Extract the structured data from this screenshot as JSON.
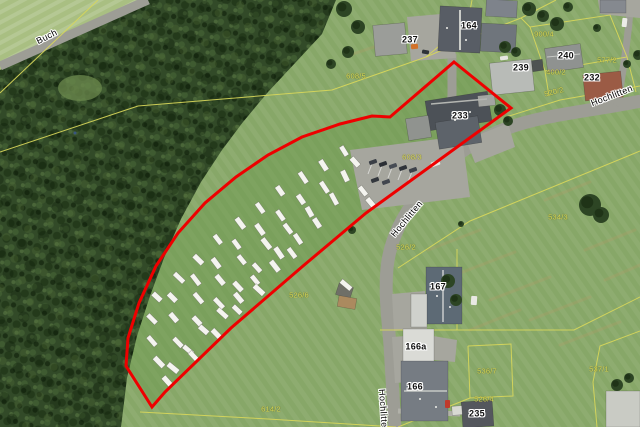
{
  "map": {
    "kind": "aerial-orthophoto-with-cadastre",
    "width": 640,
    "height": 427
  },
  "colors": {
    "meadow": "#87a768",
    "meadow_light": "#a9bf82",
    "field_tint": "#6e9950",
    "clearing": "#6c8a4e",
    "tree": "#2d4524",
    "tree_dark": "#1f3317",
    "road": "#9d9d95",
    "asphalt": "#a6a69e",
    "path": "#b1b1a9",
    "cadastral_yellow": "#d8d75a",
    "boundary_red": "#ee0000",
    "dry_grass": "#b59c66",
    "caravan_white": "#f4f4ef",
    "house_label": "#101010",
    "parcel_label": "#dedd55",
    "marker_blue": "#39567f"
  },
  "labels": {
    "streets": [
      {
        "text": "Buch",
        "x": 47,
        "y": 37,
        "rot": -27
      },
      {
        "text": "Hochlitten",
        "x": 612,
        "y": 96,
        "rot": -21
      },
      {
        "text": "Hochlitten",
        "x": 407,
        "y": 219,
        "rot": -50
      },
      {
        "text": "Hochlitten",
        "x": 383,
        "y": 411,
        "rot": 86
      }
    ],
    "house_numbers": [
      {
        "text": "164",
        "x": 469,
        "y": 26,
        "rot": 0
      },
      {
        "text": "237",
        "x": 410,
        "y": 40,
        "rot": 0
      },
      {
        "text": "240",
        "x": 566,
        "y": 56,
        "rot": 0
      },
      {
        "text": "239",
        "x": 521,
        "y": 68,
        "rot": 0
      },
      {
        "text": "232",
        "x": 592,
        "y": 78,
        "rot": 0
      },
      {
        "text": "233",
        "x": 460,
        "y": 116,
        "rot": 0
      },
      {
        "text": "167",
        "x": 438,
        "y": 287,
        "rot": 0
      },
      {
        "text": "166a",
        "x": 416,
        "y": 347,
        "rot": 0
      },
      {
        "text": "166",
        "x": 415,
        "y": 387,
        "rot": 0
      },
      {
        "text": "235",
        "x": 477,
        "y": 414,
        "rot": 0
      }
    ],
    "parcels": [
      {
        "text": "900/4",
        "x": 544,
        "y": 34,
        "rot": 0
      },
      {
        "text": "400/2",
        "x": 556,
        "y": 72,
        "rot": 0
      },
      {
        "text": "577/2",
        "x": 607,
        "y": 60,
        "rot": 0
      },
      {
        "text": "520/2",
        "x": 554,
        "y": 92,
        "rot": -14
      },
      {
        "text": "608/5",
        "x": 356,
        "y": 76,
        "rot": 0
      },
      {
        "text": "608/3",
        "x": 412,
        "y": 157,
        "rot": 0
      },
      {
        "text": "534/3",
        "x": 558,
        "y": 217,
        "rot": 0
      },
      {
        "text": "526/2",
        "x": 406,
        "y": 247,
        "rot": 0
      },
      {
        "text": "526/6",
        "x": 299,
        "y": 295,
        "rot": 0
      },
      {
        "text": "536/7",
        "x": 487,
        "y": 371,
        "rot": 0
      },
      {
        "text": "526/4",
        "x": 484,
        "y": 399,
        "rot": 0
      },
      {
        "text": "537/1",
        "x": 599,
        "y": 369,
        "rot": 0
      },
      {
        "text": "614/2",
        "x": 271,
        "y": 409,
        "rot": 0
      }
    ]
  },
  "red_boundary": {
    "color": "#ee0000",
    "width": 3,
    "points": [
      [
        454,
        62
      ],
      [
        511,
        108
      ],
      [
        366,
        213
      ],
      [
        303,
        266
      ],
      [
        231,
        328
      ],
      [
        165,
        392
      ],
      [
        152,
        407
      ],
      [
        126,
        366
      ],
      [
        128,
        338
      ],
      [
        139,
        303
      ],
      [
        156,
        266
      ],
      [
        178,
        233
      ],
      [
        205,
        203
      ],
      [
        236,
        177
      ],
      [
        268,
        155
      ],
      [
        302,
        137
      ],
      [
        340,
        124
      ],
      [
        372,
        116
      ],
      [
        390,
        117
      ]
    ]
  },
  "forest": {
    "polygon": [
      [
        148,
        0
      ],
      [
        336,
        0
      ],
      [
        322,
        34
      ],
      [
        296,
        62
      ],
      [
        268,
        92
      ],
      [
        243,
        122
      ],
      [
        222,
        150
      ],
      [
        201,
        182
      ],
      [
        181,
        219
      ],
      [
        164,
        258
      ],
      [
        150,
        296
      ],
      [
        137,
        336
      ],
      [
        127,
        378
      ],
      [
        121,
        427
      ],
      [
        0,
        427
      ],
      [
        0,
        70
      ]
    ],
    "clearing": {
      "cx": 80,
      "cy": 88,
      "rx": 22,
      "ry": 13
    }
  },
  "surfaces": {
    "topleft_meadow": [
      [
        0,
        0
      ],
      [
        150,
        0
      ],
      [
        0,
        70
      ]
    ],
    "asphalt": [
      [
        [
          350,
          150
        ],
        [
          462,
          136
        ],
        [
          470,
          197
        ],
        [
          362,
          210
        ]
      ],
      [
        [
          466,
          140
        ],
        [
          508,
          123
        ],
        [
          515,
          147
        ],
        [
          475,
          163
        ]
      ],
      [
        [
          407,
          17
        ],
        [
          452,
          13
        ],
        [
          456,
          58
        ],
        [
          411,
          61
        ]
      ],
      [
        [
          392,
          294
        ],
        [
          425,
          291
        ],
        [
          427,
          329
        ],
        [
          394,
          331
        ]
      ],
      [
        [
          392,
          337
        ],
        [
          420,
          335
        ],
        [
          423,
          381
        ],
        [
          395,
          383
        ]
      ],
      [
        [
          433,
          336
        ],
        [
          457,
          340
        ],
        [
          455,
          362
        ],
        [
          434,
          360
        ]
      ],
      [
        [
          598,
          0
        ],
        [
          640,
          0
        ],
        [
          640,
          18
        ],
        [
          600,
          14
        ]
      ]
    ]
  },
  "roads": [
    {
      "d": "M0,66 L148,0",
      "w": 9
    },
    {
      "d": "M641,101 C585,112 542,115 505,129 C468,143 444,163 424,188 C404,213 390,238 387,268 C384,300 390,332 391,362 L395,428",
      "w": 13
    },
    {
      "d": "M617,106 C623,72 628,40 631,0",
      "w": 7
    },
    {
      "d": "M452,54 L452,95 L448,138",
      "w": 9
    },
    {
      "d": "M398,411 L460,414",
      "w": 5,
      "c": "#b1b1a9"
    }
  ],
  "cadastral_lines": [
    [
      [
        0,
        93
      ],
      [
        98,
        0
      ]
    ],
    [
      [
        0,
        152
      ],
      [
        138,
        106
      ],
      [
        332,
        90
      ],
      [
        426,
        57
      ]
    ],
    [
      [
        426,
        57
      ],
      [
        470,
        38
      ],
      [
        521,
        18
      ],
      [
        556,
        0
      ]
    ],
    [
      [
        521,
        18
      ],
      [
        530,
        27
      ],
      [
        545,
        71
      ],
      [
        549,
        96
      ]
    ],
    [
      [
        530,
        27
      ],
      [
        610,
        15
      ],
      [
        627,
        57
      ],
      [
        545,
        71
      ]
    ],
    [
      [
        627,
        57
      ],
      [
        636,
        92
      ]
    ],
    [
      [
        640,
        86
      ],
      [
        560,
        100
      ],
      [
        506,
        117
      ]
    ],
    [
      [
        398,
        268
      ],
      [
        470,
        221
      ],
      [
        640,
        151
      ]
    ],
    [
      [
        380,
        330
      ],
      [
        574,
        330
      ],
      [
        640,
        297
      ]
    ],
    [
      [
        457,
        249
      ],
      [
        457,
        330
      ]
    ],
    [
      [
        468,
        346
      ],
      [
        511,
        344
      ],
      [
        513,
        396
      ],
      [
        470,
        398
      ],
      [
        468,
        346
      ]
    ],
    [
      [
        470,
        398
      ],
      [
        398,
        427
      ]
    ],
    [
      [
        640,
        331
      ],
      [
        600,
        346
      ],
      [
        593,
        382
      ],
      [
        597,
        427
      ]
    ],
    [
      [
        140,
        412
      ],
      [
        268,
        419
      ],
      [
        396,
        427
      ]
    ],
    [
      [
        472,
        0
      ],
      [
        468,
        22
      ],
      [
        426,
        57
      ]
    ]
  ],
  "buildings": [
    {
      "n": "building-233-main",
      "x": 427,
      "y": 96,
      "w": 63,
      "h": 30,
      "r": -9,
      "f": "#4c5157"
    },
    {
      "n": "building-233-south-wing",
      "x": 437,
      "y": 119,
      "w": 43,
      "h": 27,
      "r": -9,
      "f": "#5d636a"
    },
    {
      "n": "building-233-west-annex",
      "x": 407,
      "y": 117,
      "w": 23,
      "h": 22,
      "r": -9,
      "f": "#90938f"
    },
    {
      "n": "building-164-main",
      "x": 439,
      "y": 7,
      "w": 42,
      "h": 45,
      "r": 3,
      "f": "#585d65"
    },
    {
      "n": "building-164-east-wing",
      "x": 481,
      "y": 24,
      "w": 35,
      "h": 28,
      "r": 3,
      "f": "#6f757c"
    },
    {
      "n": "building-164-north-barn",
      "x": 486,
      "y": 0,
      "w": 31,
      "h": 17,
      "r": 3,
      "f": "#7e838b"
    },
    {
      "n": "building-237",
      "x": 374,
      "y": 24,
      "w": 32,
      "h": 31,
      "r": -5,
      "f": "#9b9d99"
    },
    {
      "n": "building-240",
      "x": 546,
      "y": 46,
      "w": 36,
      "h": 24,
      "r": -8,
      "f": "#8f9290"
    },
    {
      "n": "shed-240",
      "x": 532,
      "y": 60,
      "w": 11,
      "h": 11,
      "r": -8,
      "f": "#4e5352"
    },
    {
      "n": "building-239",
      "x": 491,
      "y": 61,
      "w": 42,
      "h": 32,
      "r": -6,
      "f": "#b8bbb7"
    },
    {
      "n": "garage-239",
      "x": 478,
      "y": 95,
      "w": 17,
      "h": 11,
      "r": -6,
      "f": "#a3a5a1"
    },
    {
      "n": "building-232",
      "x": 584,
      "y": 73,
      "w": 38,
      "h": 26,
      "r": -6,
      "f": "#9b5b45"
    },
    {
      "n": "building-167",
      "x": 426,
      "y": 267,
      "w": 36,
      "h": 57,
      "r": 0,
      "f": "#5d6a75"
    },
    {
      "n": "building-167-annex",
      "x": 411,
      "y": 294,
      "w": 16,
      "h": 33,
      "r": 0,
      "f": "#cfd1cc"
    },
    {
      "n": "building-166a",
      "x": 403,
      "y": 329,
      "w": 31,
      "h": 33,
      "r": 0,
      "f": "#dadbd6"
    },
    {
      "n": "building-166",
      "x": 401,
      "y": 361,
      "w": 47,
      "h": 60,
      "r": 0,
      "f": "#767c83"
    },
    {
      "n": "building-235",
      "x": 462,
      "y": 401,
      "w": 31,
      "h": 26,
      "r": -4,
      "f": "#54575d"
    },
    {
      "n": "shed-235",
      "x": 452,
      "y": 406,
      "w": 10,
      "h": 9,
      "r": -4,
      "f": "#d8d9d3"
    },
    {
      "n": "building-se-corner",
      "x": 606,
      "y": 391,
      "w": 34,
      "h": 36,
      "r": 0,
      "f": "#c9cbc4"
    },
    {
      "n": "building-ne-corner",
      "x": 600,
      "y": 0,
      "w": 26,
      "h": 13,
      "r": 0,
      "f": "#85898f"
    },
    {
      "n": "shed-meadow",
      "x": 337,
      "y": 285,
      "w": 15,
      "h": 12,
      "r": 18,
      "f": "#6f6f67"
    },
    {
      "n": "ground-patch-shed",
      "x": 338,
      "y": 297,
      "w": 18,
      "h": 11,
      "r": 10,
      "f": "#ab8a5f"
    }
  ],
  "roof_lines": [
    [
      443,
      270,
      443,
      322,
      1.2,
      "#e3e4e1"
    ],
    [
      404,
      391,
      447,
      391,
      1.3,
      "#d7d8d3"
    ],
    [
      460,
      10,
      460,
      50,
      2,
      "#caccc8"
    ],
    [
      431,
      104,
      487,
      99,
      1.4,
      "#b4b6b2"
    ],
    [
      547,
      57,
      580,
      54,
      1,
      "#c6c8c4"
    ]
  ],
  "roof_dots": [
    [
      437,
      296
    ],
    [
      450,
      307
    ],
    [
      420,
      399
    ],
    [
      436,
      407
    ],
    [
      455,
      120
    ],
    [
      470,
      112
    ],
    [
      447,
      28
    ],
    [
      466,
      40
    ]
  ],
  "trees": [
    [
      529,
      9,
      7
    ],
    [
      543,
      16,
      6
    ],
    [
      557,
      24,
      7
    ],
    [
      568,
      7,
      5
    ],
    [
      597,
      28,
      4
    ],
    [
      344,
      9,
      8
    ],
    [
      358,
      27,
      7
    ],
    [
      348,
      52,
      6
    ],
    [
      331,
      64,
      5
    ],
    [
      505,
      47,
      6
    ],
    [
      516,
      52,
      5
    ],
    [
      500,
      110,
      6
    ],
    [
      508,
      121,
      5
    ],
    [
      590,
      205,
      11
    ],
    [
      601,
      215,
      8
    ],
    [
      448,
      281,
      7
    ],
    [
      456,
      300,
      6
    ],
    [
      638,
      55,
      5
    ],
    [
      627,
      64,
      4
    ],
    [
      617,
      385,
      6
    ],
    [
      629,
      378,
      5
    ],
    [
      461,
      224,
      3
    ],
    [
      352,
      230,
      4
    ]
  ],
  "vehicles": [
    [
      369,
      160,
      8,
      4,
      -20,
      "#3a3f46"
    ],
    [
      379,
      162,
      8,
      4,
      -20,
      "#2b2f35"
    ],
    [
      389,
      164,
      8,
      4,
      -20,
      "#474c54"
    ],
    [
      399,
      166,
      8,
      4,
      -20,
      "#30343a"
    ],
    [
      409,
      168,
      8,
      4,
      -20,
      "#3d424a"
    ],
    [
      371,
      178,
      8,
      4,
      -20,
      "#33373d"
    ],
    [
      382,
      180,
      8,
      4,
      -20,
      "#41464e"
    ],
    [
      431,
      161,
      9,
      5,
      -20,
      "#e8e8e3"
    ],
    [
      622,
      18,
      5,
      9,
      6,
      "#ecece7"
    ],
    [
      471,
      296,
      6,
      9,
      4,
      "#e9e9e4"
    ],
    [
      500,
      56,
      8,
      4,
      -8,
      "#e6e6e1"
    ],
    [
      411,
      44,
      7,
      5,
      -5,
      "#d2722a"
    ],
    [
      445,
      400,
      5,
      8,
      0,
      "#c03a2b"
    ],
    [
      422,
      50,
      7,
      4,
      10,
      "#2e3237"
    ]
  ],
  "parking_stripes": [
    [
      368,
      174,
      373,
      161
    ],
    [
      378,
      176,
      383,
      163
    ],
    [
      388,
      178,
      393,
      165
    ],
    [
      398,
      180,
      403,
      167
    ],
    [
      408,
      182,
      413,
      169
    ]
  ],
  "streaks": [
    [
      428,
      250,
      480,
      230
    ],
    [
      455,
      275,
      515,
      252
    ],
    [
      490,
      300,
      550,
      277
    ],
    [
      530,
      320,
      590,
      297
    ],
    [
      560,
      345,
      620,
      322
    ],
    [
      470,
      330,
      520,
      310
    ],
    [
      585,
      250,
      635,
      230
    ],
    [
      605,
      280,
      640,
      265
    ],
    [
      545,
      200,
      590,
      182
    ],
    [
      350,
      55,
      395,
      40
    ]
  ],
  "caravans": {
    "size": [
      11,
      5
    ],
    "rows": [
      {
        "p0": [
          345,
          152
        ],
        "c": [
          248,
          205
        ],
        "p2": [
          158,
          298
        ],
        "n": 10
      },
      {
        "p0": [
          345,
          175
        ],
        "c": [
          248,
          228
        ],
        "p2": [
          152,
          318
        ],
        "n": 10
      },
      {
        "p0": [
          333,
          199
        ],
        "c": [
          243,
          252
        ],
        "p2": [
          152,
          340
        ],
        "n": 9
      },
      {
        "p0": [
          318,
          224
        ],
        "c": [
          238,
          278
        ],
        "p2": [
          158,
          362
        ],
        "n": 9
      },
      {
        "p0": [
          292,
          252
        ],
        "c": [
          228,
          300
        ],
        "p2": [
          172,
          368
        ],
        "n": 8
      },
      {
        "p0": [
          258,
          290
        ],
        "c": [
          220,
          330
        ],
        "p2": [
          168,
          382
        ],
        "n": 5
      }
    ],
    "extras": [
      [
        363,
        191,
        52
      ],
      [
        371,
        203,
        50
      ],
      [
        346,
        285,
        40
      ],
      [
        355,
        162,
        48
      ]
    ]
  },
  "markers": {
    "survey_point_blue": {
      "x": 75,
      "y": 133
    }
  }
}
